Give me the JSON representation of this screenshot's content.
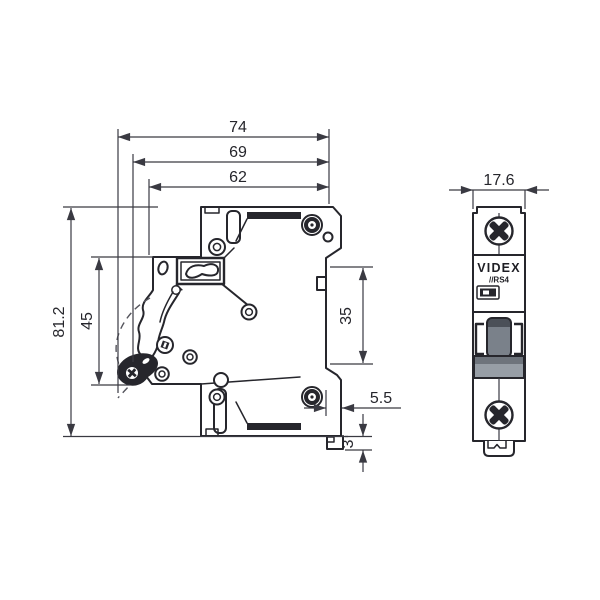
{
  "drawing": {
    "type": "dimensional technical drawing, single-pole modular circuit breaker",
    "units_implied": "mm"
  },
  "side_view": {
    "name": "side-profile-view",
    "dimensions": {
      "total_width": "74",
      "width_with_handle": "69",
      "body_width": "62",
      "total_height": "81.2",
      "front_section_height": "45",
      "din_recess_height": "35",
      "rear_clip_depth": "5.5",
      "clip_protrusion": "3"
    }
  },
  "front_view": {
    "name": "front-view",
    "dimensions": {
      "width": "17.6"
    },
    "brand_label": "VIDEX",
    "series_label": "//RS4"
  },
  "colors": {
    "line": "#26262c",
    "dimension": "#3a3a42",
    "toggle_gray": "#7a818a",
    "toggle_dark": "#4b5058",
    "band_gray": "#979ea6",
    "band_dark": "#6e747c",
    "background": "#ffffff"
  }
}
